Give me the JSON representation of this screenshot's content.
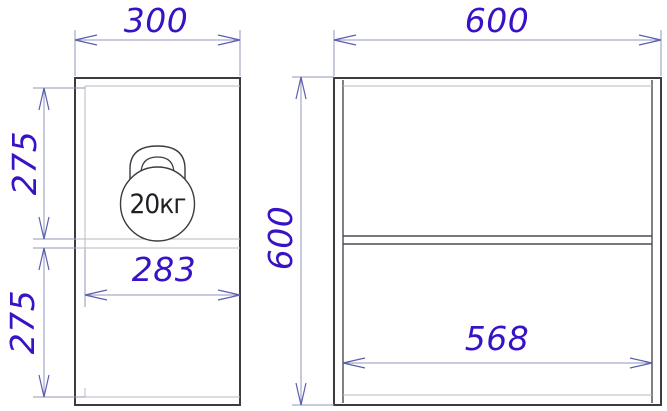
{
  "drawing": {
    "type": "furniture-two-view-dimension-drawing",
    "palette": {
      "dimension_text": "#3812c4",
      "object_line": "#3b3b42",
      "hidden_line": "#b8b8bc",
      "dimension_line": "#9094bd",
      "background": "#ffffff"
    },
    "side_view": {
      "name": "side view (depth x height)",
      "width_dim": "300",
      "inner_depth_dim": "283",
      "upper_section_dim": "275",
      "lower_section_dim": "275",
      "load_symbol": "kettlebell",
      "load_label": "20кг"
    },
    "front_view": {
      "name": "front view (width x height)",
      "width_dim": "600",
      "height_dim": "600",
      "inner_width_dim": "568"
    }
  }
}
